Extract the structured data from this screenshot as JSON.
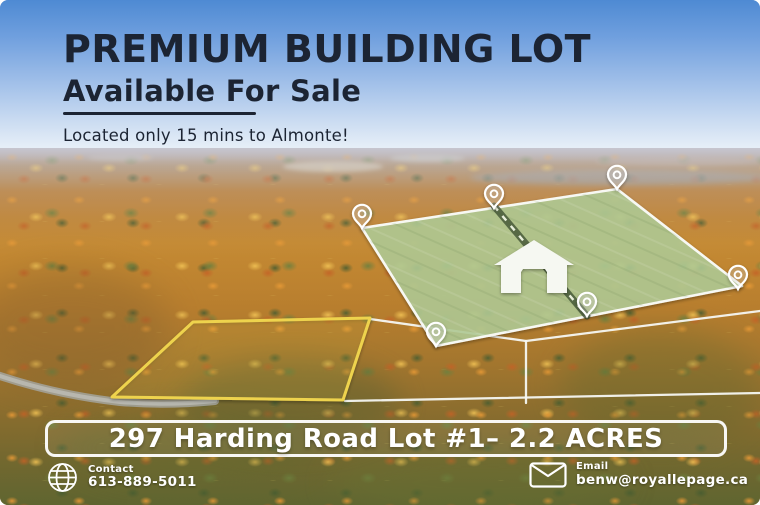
{
  "header": {
    "title": "PREMIUM BUILDING LOT",
    "subtitle": "Available For Sale",
    "tagline": "Located only 15 mins to Almonte!"
  },
  "banner": {
    "text": "297 Harding Road Lot #1– 2.2 ACRES"
  },
  "footer": {
    "contact": {
      "icon": "globe-icon",
      "label": "Contact",
      "phone": "613-889-5011"
    },
    "email": {
      "icon": "envelope-icon",
      "label": "Email",
      "address": "benw@royallepage.ca"
    }
  },
  "colors": {
    "headline_navy": "#1c2433",
    "sky_top_blue": "#4e8ad3",
    "parcel_green_fill": "rgba(178,204,150,0.85)",
    "parcel_border_white": "#f7f8f3",
    "lot_outline_yellow": "#eed34e",
    "footer_text_white": "#ffffff",
    "house_icon_white": "#f6f8f2"
  },
  "overlay": {
    "green_parcel": {
      "points": "362,228 617,189 742,286 436,346",
      "fill": "rgba(178,204,150,0.85)",
      "stroke": "#f7f8f3"
    },
    "yellow_lot": {
      "points": "193,322 370,318 343,400 112,397",
      "stroke": "#eed34e",
      "fill": "rgba(238,211,78,0.10)"
    },
    "survey_lines": [
      "370,319 526,341",
      "526,341 526,403",
      "526,341 760,311",
      "345,401 760,393"
    ],
    "driveway": {
      "x1": "494",
      "y1": "206",
      "x2": "587",
      "y2": "316"
    },
    "house": {
      "points": "534,240 574,265 567,265 567,293 547,293 547,272 545,269 523,269 521,272 521,293 501,293 501,265 494,265",
      "fill": "#f6f8f2"
    },
    "pins": [
      "translate(362,228)",
      "translate(494,208)",
      "translate(617,189)",
      "translate(738,289)",
      "translate(587,316)",
      "translate(436,346)"
    ]
  }
}
